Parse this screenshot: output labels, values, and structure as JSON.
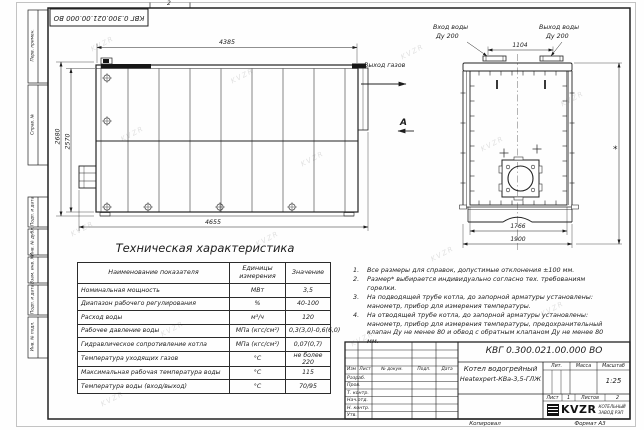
{
  "page": {
    "sheet_marker_top": "2",
    "stamp_top_left": "КВГ 0.300.021.00.000 ВО",
    "copied_label": "Копировал",
    "format_label": "Формат А3",
    "watermark": "KVZR"
  },
  "frame": {
    "left_labels": [
      "Перв. примен.",
      "Справ. №",
      "Подп. и дата",
      "Инв. № дубл.",
      "Взам. инв. №",
      "Подп. и дата",
      "Инв. № подл."
    ]
  },
  "drawing": {
    "side_view": {
      "dim_top": "4385",
      "dim_bottom": "4655",
      "dim_height_outer": "2680",
      "dim_height_inner": "2570",
      "gas_outlet_label": "Выход газов",
      "view_label": "А"
    },
    "end_view": {
      "water_inlet_line1": "Вход воды",
      "water_inlet_line2": "Ду 200",
      "water_outlet_line1": "Выход воды",
      "water_outlet_line2": "Ду 200",
      "dim_flange_spacing": "1104",
      "dim_inner_width": "1766",
      "dim_outer_width": "1900",
      "dim_height_ref": "*"
    }
  },
  "spec_table": {
    "title": "Техническая характеристика",
    "headers": [
      "Наименование показателя",
      "Единицы измерения",
      "Значение"
    ],
    "rows": [
      [
        "Номинальная мощность",
        "МВт",
        "3,5"
      ],
      [
        "Диапазон рабочего регулирования",
        "%",
        "40-100"
      ],
      [
        "Расход воды",
        "м³/ч",
        "120"
      ],
      [
        "Рабочее давление воды",
        "МПа (кгс/см²)",
        "0,3(3,0)-0,6(6,0)"
      ],
      [
        "Гидравлическое сопротивление котла",
        "МПа (кгс/см²)",
        "0,07(0,7)"
      ],
      [
        "Температура уходящих газов",
        "°С",
        "не более 220"
      ],
      [
        "Максимальная рабочая температура воды",
        "°С",
        "115"
      ],
      [
        "Температура воды (вход/выход)",
        "°С",
        "70/95"
      ]
    ]
  },
  "notes": {
    "items": [
      {
        "n": "1.",
        "text": "Все размеры для справок, допустимые отклонения ±100 мм."
      },
      {
        "n": "2.",
        "text": "Размер* выбирается индивидуально согласно тех. требованиям горелки."
      },
      {
        "n": "3.",
        "text": "На подводящей трубе котла, до запорной арматуры установлены: манометр, прибор для измерения температуры."
      },
      {
        "n": "4.",
        "text": "На отводящей трубе котла, до запорной арматуры установлены: манометр, прибор для измерения температуры, предохранительный клапан Ду не менее 80 и обвод с обратным клапаном Ду не менее 80 мм."
      }
    ]
  },
  "title_block": {
    "doc_number": "КВГ 0.300.021.00.000 ВО",
    "product_line1": "Котел водогрейный",
    "product_line2": "Heatexpert-КВа-3,5-ГЛЖ",
    "header_cells": [
      "Изм",
      "Лист",
      "№ докум.",
      "Подп.",
      "Дата"
    ],
    "row_labels": [
      "Разраб.",
      "Пров.",
      "Т. контр.",
      "Нач.отд.",
      "Н. контр.",
      "Утв."
    ],
    "lit_label": "Лит.",
    "mass_label": "Масса",
    "scale_label": "Масштаб",
    "scale_value": "1:25",
    "sheet_label": "Лист",
    "sheet_value": "1",
    "sheets_label": "Листов",
    "sheets_value": "2",
    "logo_text": "KVZR",
    "logo_caption1": "КОТЕЛЬНЫЙ",
    "logo_caption2": "ЗАВОД РЭП"
  }
}
